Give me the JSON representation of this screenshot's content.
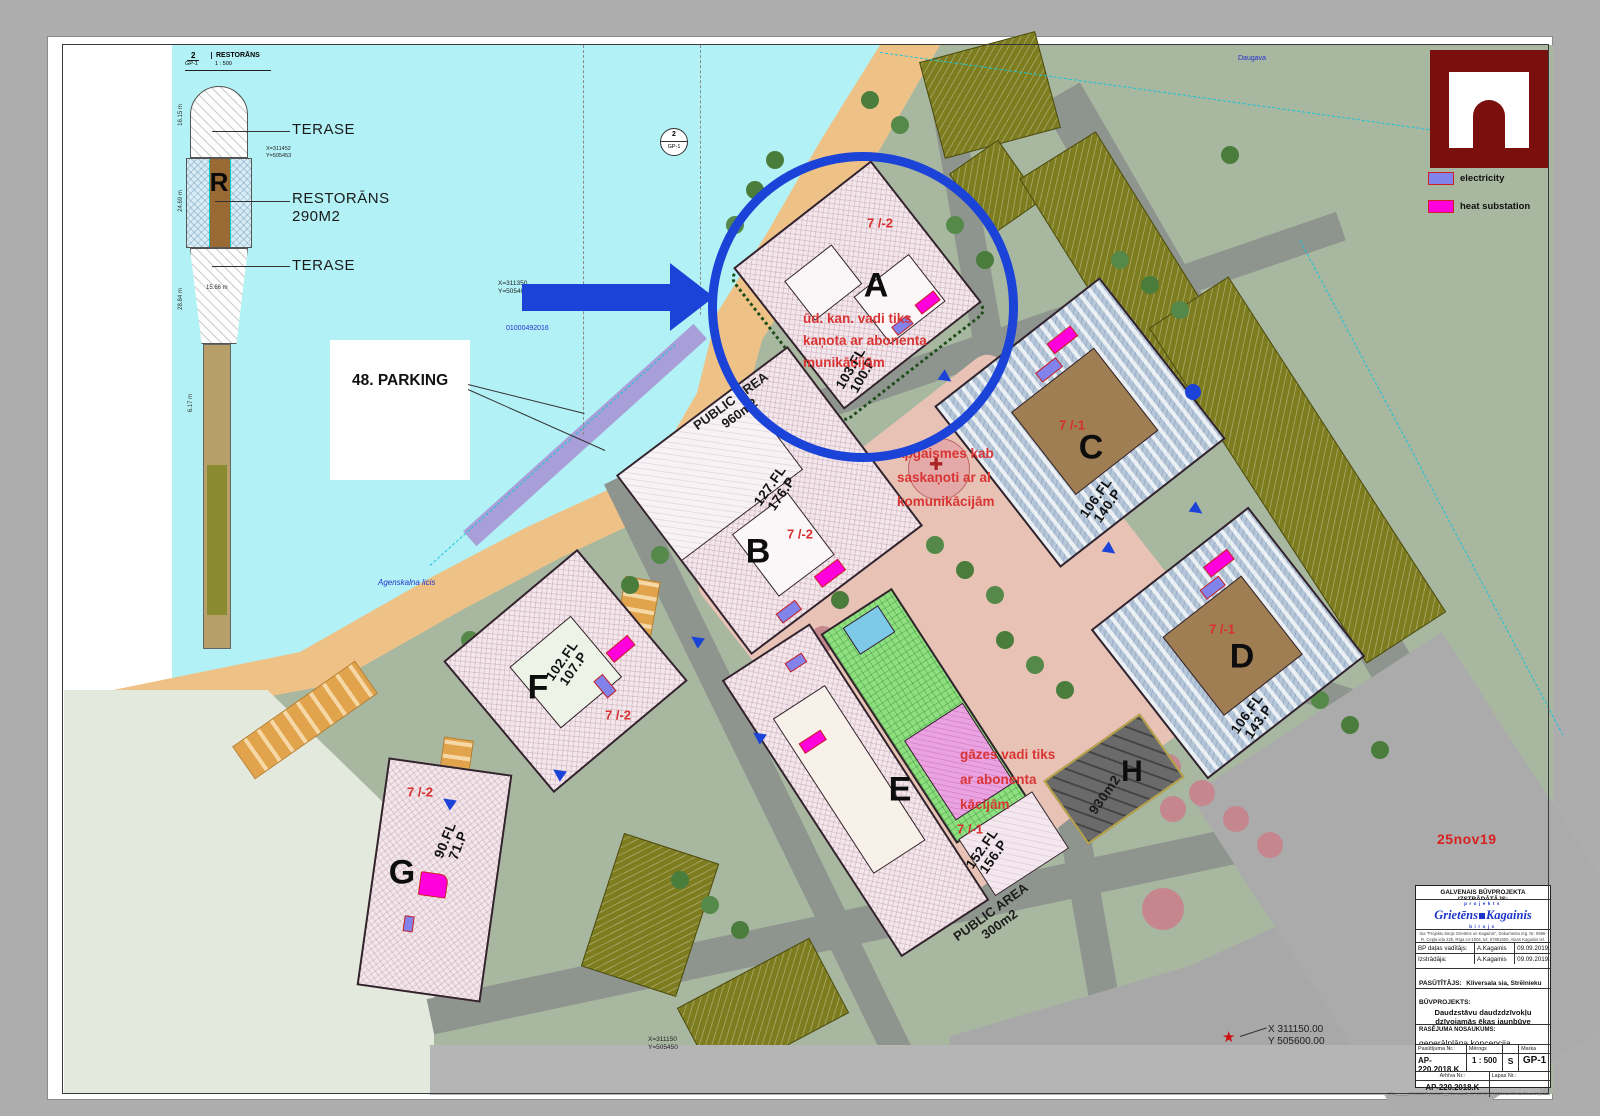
{
  "sheet": {
    "date": "25nov19"
  },
  "detail": {
    "header": {
      "num": "2",
      "sheet": "GP-1",
      "title": "RESTORĀNS",
      "scale": "1 : 500"
    },
    "marker": {
      "num": "2",
      "sheet": "GP-1"
    },
    "labels": {
      "terase_top": "TERASE",
      "restorans": "RESTORĀNS",
      "area": "290M2",
      "terase_bottom": "TERASE",
      "letter": "R"
    },
    "dims": {
      "d1": "16.15 m",
      "d2": "24.69 m",
      "d3": "28.84 m",
      "d4": "6.17 m",
      "w": "15.66 m"
    },
    "coords": {
      "x": "X=311452",
      "y": "Y=505453"
    }
  },
  "legend": {
    "electricity": "electricity",
    "heat": "heat substation",
    "colors": {
      "electricity": "#8283ea",
      "heat": "#ff00dd",
      "logo": "#7a100d",
      "highlight": "#1b43d8"
    }
  },
  "map": {
    "parking_label": "48. PARKING",
    "water_label": "Agenskalna licis",
    "river_label": "Daugava",
    "cadastre": "01000492016",
    "coord_arrow": {
      "x": "X=311350",
      "y": "Y=505400"
    },
    "coord_star": {
      "x": "X 311150.00",
      "y": "Y 505600.00"
    },
    "coord_bottom": {
      "x": "X=311150",
      "y": "Y=505450"
    },
    "notes": {
      "a": {
        "l1": "ūd. kan. vadi tiks",
        "l2": "kaņota ar abonenta",
        "l3": "munikācijām"
      },
      "c": {
        "l1": "apgaismes kab",
        "l2": "saskaņoti ar al",
        "l3": "komunikācijām"
      },
      "e": {
        "l1": "gāzes vadi tiks",
        "l2": "ar abonenta",
        "l3": "kācijām"
      }
    }
  },
  "buildings": {
    "a": {
      "letter": "A",
      "levels": "7 /-2",
      "fl": "103.FL",
      "p": "100.P"
    },
    "b": {
      "letter": "B",
      "levels": "7 /-2",
      "fl": "127.FL",
      "p": "176.P",
      "public1": "PUBLIC AREA",
      "public2": "960m2"
    },
    "c": {
      "letter": "C",
      "levels": "7 /-1",
      "fl": "106.FL",
      "p": "140.P"
    },
    "d": {
      "letter": "D",
      "levels": "7 /-1",
      "fl": "106.FL",
      "p": "143.P"
    },
    "e": {
      "letter": "E",
      "levels": "7 /-1",
      "fl": "152.FL",
      "p": "156.P",
      "public1": "PUBLIC AREA",
      "public2": "300m2"
    },
    "f": {
      "letter": "F",
      "levels": "7 /-2",
      "fl": "102.FL",
      "p": "107.P"
    },
    "g": {
      "letter": "G",
      "levels": "7 /-2",
      "fl": "90.FL",
      "p": "71.P"
    },
    "h": {
      "letter": "H",
      "area": "930m2"
    }
  },
  "titleblock": {
    "header": "GALVENAIS BŪVPROJEKTA IZSTRĀDĀTĀJS:",
    "logo": {
      "top": "projekts",
      "name1": "Grietēns",
      "name2": "Kagainis",
      "bottom": "birojs"
    },
    "fineprint": "Sia \"Projektu birojs Grietēns un Kagainis\", Dokumenta reģ. Nr. 0986-R, Cepļa iela 22b, Rīga LV-1004, tel. 67891500, Alans Kagainis tel. 26327118, e-pasts: ak@inb.lv, alanek86@gmail.com",
    "rows": {
      "r1_label": "BP daļas vadītājs:",
      "r1_name": "A.Kagainis",
      "r1_date": "09.09.2019.",
      "r2_label": "Izstrādāja:",
      "r2_name": "A.Kagainis",
      "r2_date": "09.09.2019."
    },
    "client_label": "PASŪTĪTĀJS:",
    "client_value": "Kliversala sia, Strēlnieku 1-8, Rīga,  LV-1010",
    "project_label": "BŪVPROJEKTS:",
    "project_line1": "Daudzstāvu daudzdzīvokļu",
    "project_line2": "dzīvojamās ēkas jaunbūve",
    "project_address": "Kliversala, Trijādības iela 1, Rīga",
    "drawing_label": "RASĒJUMA NOSAUKUMS:",
    "drawing_value": "generālplāna koncepcija",
    "order_label": "Pasūtījuma Nr.:",
    "order_value": "AP-220.2018.K",
    "scale_label": "Mērogs",
    "scale_value": "1 : 500",
    "stage_value": "S",
    "marka_label": "Marka",
    "marka_value": "GP-1",
    "archive_label": "Arhīva Nr.:",
    "archive_value": "AP-220.2018.K",
    "sheetnum_label": "Lapas Nr.:",
    "microtext": "GPA______PROJEKTI_040129__Kliversala2_GP\\GPREVIT\\220.Kliv.GP-8b.25nov19_skat.majas koncepcija.rvt"
  }
}
